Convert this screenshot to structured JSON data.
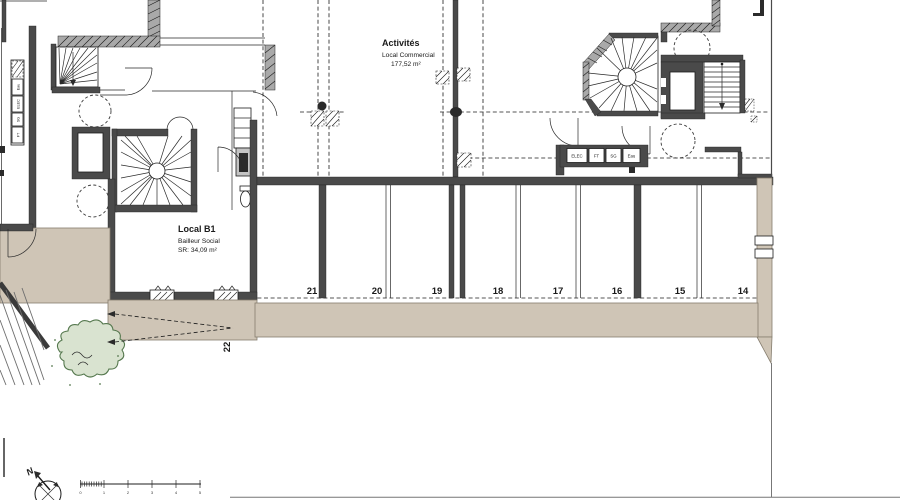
{
  "rooms": {
    "activites": {
      "title": "Activités",
      "subtitle": "Local Commercial",
      "area": "177,52 m²"
    },
    "local_b1": {
      "title": "Local B1",
      "subtitle": "Bailleur Social",
      "area": "SR:  34,09 m²"
    }
  },
  "parking": {
    "spaces": [
      "21",
      "20",
      "19",
      "18",
      "17",
      "16",
      "15",
      "14"
    ],
    "ramp_space": "22"
  },
  "utilities": {
    "right_row": [
      "ELEC",
      "FT",
      "SG",
      "Eau"
    ],
    "left_column": [
      "Eau",
      "ELEC",
      "SG",
      "FT"
    ]
  },
  "compass": {
    "north": "N"
  },
  "scale_bar": {
    "ticks": [
      "0",
      "1",
      "2",
      "3",
      "4",
      "5"
    ]
  },
  "colors": {
    "wall": "#4a4a4a",
    "wall_light": "#a9a9a9",
    "beige": "#cfc5b6",
    "beige_border": "#857d6e",
    "bush_fill": "#d9e3d0",
    "bush_stroke": "#55784e",
    "line": "#1c1c1c"
  }
}
